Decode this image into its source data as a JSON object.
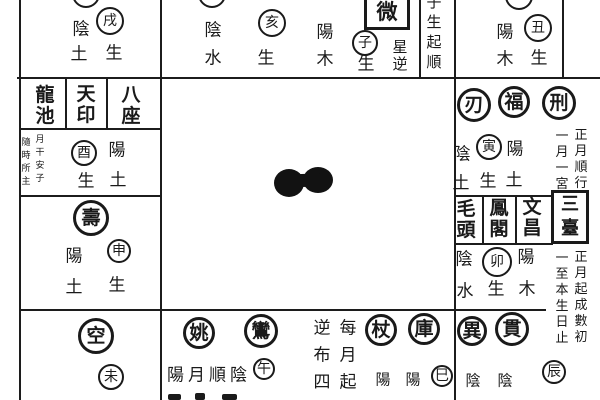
{
  "colors": {
    "ink": "#1a1a1a",
    "paper": "#ffffff"
  },
  "elements": [
    {
      "name": "cutoff-circle-xu-palace",
      "kind": "circle",
      "x": 86,
      "y": -6,
      "r": 14,
      "text": ""
    },
    {
      "name": "branch-circle-xu",
      "kind": "circle",
      "x": 110,
      "y": 21,
      "r": 14,
      "text": "戌"
    },
    {
      "name": "label-yin-xu",
      "kind": "char",
      "x": 81,
      "y": 30,
      "text": "陰"
    },
    {
      "name": "label-earth-xu",
      "kind": "char",
      "x": 79,
      "y": 55,
      "text": "土"
    },
    {
      "name": "label-sheng-xu",
      "kind": "char",
      "x": 114,
      "y": 54,
      "text": "生"
    },
    {
      "name": "cutoff-circle-hai-palace",
      "kind": "circle",
      "x": 212,
      "y": -6,
      "r": 14,
      "text": ""
    },
    {
      "name": "label-yin-hai",
      "kind": "char",
      "x": 213,
      "y": 31,
      "text": "陰"
    },
    {
      "name": "label-water-hai",
      "kind": "char",
      "x": 213,
      "y": 59,
      "text": "水"
    },
    {
      "name": "branch-circle-hai",
      "kind": "circle",
      "x": 272,
      "y": 23,
      "r": 14,
      "text": "亥"
    },
    {
      "name": "label-sheng-hai",
      "kind": "char",
      "x": 266,
      "y": 59,
      "text": "生"
    },
    {
      "name": "star-box-ziwei",
      "kind": "box",
      "x": 387,
      "y": 11,
      "w": 46,
      "h": 38,
      "fs": 21,
      "text": "微"
    },
    {
      "name": "label-yang-zi",
      "kind": "char",
      "x": 325,
      "y": 33,
      "text": "陽"
    },
    {
      "name": "label-wood-zi",
      "kind": "char",
      "x": 325,
      "y": 60,
      "text": "木"
    },
    {
      "name": "branch-circle-zi",
      "kind": "circle",
      "x": 365,
      "y": 43,
      "r": 13,
      "text": "子"
    },
    {
      "name": "label-sheng-zi",
      "kind": "char",
      "x": 366,
      "y": 65,
      "text": "生"
    },
    {
      "name": "note-star-reverse",
      "kind": "vchar",
      "x": 400,
      "y": 56,
      "fs": 15,
      "lh": 17,
      "text": "星\n逆"
    },
    {
      "name": "note-zi-sheng-qi-shun",
      "kind": "vchar",
      "x": 434,
      "y": 32,
      "fs": 15,
      "lh": 20,
      "text": "子\n生\n起\n順"
    },
    {
      "name": "cutoff-circle-chou-palace",
      "kind": "circle",
      "x": 519,
      "y": -4,
      "r": 14,
      "text": ""
    },
    {
      "name": "label-yang-chou",
      "kind": "char",
      "x": 505,
      "y": 33,
      "text": "陽"
    },
    {
      "name": "branch-circle-chou",
      "kind": "circle",
      "x": 538,
      "y": 28,
      "r": 14,
      "text": "丑"
    },
    {
      "name": "label-wood-chou",
      "kind": "char",
      "x": 505,
      "y": 60,
      "text": "木"
    },
    {
      "name": "label-sheng-chou",
      "kind": "char",
      "x": 539,
      "y": 59,
      "text": "生"
    },
    {
      "name": "star-box-longchi",
      "kind": "headerv",
      "x": 45,
      "y": 106,
      "text": "龍\n池"
    },
    {
      "name": "star-box-tianyin",
      "kind": "headerv",
      "x": 86,
      "y": 105,
      "text": "天\n印"
    },
    {
      "name": "star-box-bazuo",
      "kind": "headerv",
      "x": 131,
      "y": 106,
      "text": "八\n座"
    },
    {
      "name": "note-sui-shi-suo-zhu",
      "kind": "vchar tiny",
      "x": 26,
      "y": 163,
      "fs": 9,
      "lh": 13,
      "text": "隨\n時\n所\n主"
    },
    {
      "name": "note-yue-gan-an-zi",
      "kind": "vchar tiny",
      "x": 40,
      "y": 160,
      "fs": 9,
      "lh": 13,
      "text": "月\n干\n安\n子"
    },
    {
      "name": "branch-circle-you",
      "kind": "circle",
      "x": 84,
      "y": 153,
      "r": 13,
      "text": "酉"
    },
    {
      "name": "label-yang-you",
      "kind": "char",
      "x": 117,
      "y": 151,
      "text": "陽"
    },
    {
      "name": "label-sheng-you",
      "kind": "char",
      "x": 86,
      "y": 182,
      "text": "生"
    },
    {
      "name": "label-earth-you",
      "kind": "char",
      "x": 118,
      "y": 181,
      "text": "土"
    },
    {
      "name": "star-circle-shou",
      "kind": "circle star",
      "x": 91,
      "y": 218,
      "r": 18,
      "text": "壽"
    },
    {
      "name": "label-yang-shen",
      "kind": "char",
      "x": 74,
      "y": 257,
      "text": "陽"
    },
    {
      "name": "branch-circle-shen",
      "kind": "circle",
      "x": 119,
      "y": 251,
      "r": 12,
      "text": "申"
    },
    {
      "name": "label-earth-shen",
      "kind": "char",
      "x": 74,
      "y": 288,
      "text": "土"
    },
    {
      "name": "label-sheng-shen",
      "kind": "char",
      "x": 117,
      "y": 286,
      "text": "生"
    },
    {
      "name": "star-circle-kong",
      "kind": "circle star",
      "x": 96,
      "y": 336,
      "r": 18,
      "text": "空"
    },
    {
      "name": "branch-circle-wei",
      "kind": "circle",
      "x": 111,
      "y": 377,
      "r": 13,
      "text": "未"
    },
    {
      "name": "star-circle-yao",
      "kind": "circle star",
      "x": 199,
      "y": 333,
      "r": 16,
      "text": "姚"
    },
    {
      "name": "star-circle-luan",
      "kind": "circle star",
      "x": 261,
      "y": 331,
      "r": 17,
      "text": "鸞"
    },
    {
      "name": "note-yang-yue-shun-yin",
      "kind": "hchar",
      "x": 209,
      "y": 376,
      "fs": 17,
      "ls": 4,
      "text": "陽月順陰"
    },
    {
      "name": "branch-circle-wu",
      "kind": "circle",
      "x": 264,
      "y": 369,
      "r": 11,
      "text": "午"
    },
    {
      "name": "clipped-text-fragment",
      "kind": "fragment",
      "x": 168,
      "y": 394,
      "w": 13,
      "h": 6
    },
    {
      "name": "clipped-text-fragment",
      "kind": "fragment",
      "x": 195,
      "y": 393,
      "w": 10,
      "h": 7
    },
    {
      "name": "clipped-text-fragment",
      "kind": "fragment",
      "x": 222,
      "y": 394,
      "w": 15,
      "h": 6
    },
    {
      "name": "note-ni-bu-si",
      "kind": "vchar",
      "x": 322,
      "y": 356,
      "fs": 17,
      "lh": 27,
      "text": "逆\n布\n四"
    },
    {
      "name": "note-mei-yue-qi",
      "kind": "vchar",
      "x": 348,
      "y": 356,
      "fs": 17,
      "lh": 27,
      "text": "每\n月\n起"
    },
    {
      "name": "star-circle-zhang",
      "kind": "circle star",
      "x": 381,
      "y": 330,
      "r": 16,
      "text": "杖"
    },
    {
      "name": "star-circle-ku",
      "kind": "circle star",
      "x": 424,
      "y": 329,
      "r": 16,
      "text": "庫"
    },
    {
      "name": "label-yang-si-1",
      "kind": "char sm",
      "x": 383,
      "y": 380,
      "text": "陽"
    },
    {
      "name": "label-yang-si-2",
      "kind": "char sm",
      "x": 413,
      "y": 380,
      "text": "陽"
    },
    {
      "name": "branch-circle-si",
      "kind": "circle",
      "x": 442,
      "y": 376,
      "r": 11,
      "text": "巳"
    },
    {
      "name": "star-circle-yi",
      "kind": "circle star",
      "x": 472,
      "y": 331,
      "r": 15,
      "text": "異"
    },
    {
      "name": "star-circle-guan",
      "kind": "circle star",
      "x": 512,
      "y": 329,
      "r": 17,
      "text": "貫"
    },
    {
      "name": "label-yin-chen-1",
      "kind": "char sm",
      "x": 473,
      "y": 381,
      "text": "陰"
    },
    {
      "name": "label-yin-chen-2",
      "kind": "char sm",
      "x": 505,
      "y": 381,
      "text": "陰"
    },
    {
      "name": "branch-circle-chen",
      "kind": "circle",
      "x": 554,
      "y": 372,
      "r": 12,
      "text": "辰"
    },
    {
      "name": "star-circle-ren",
      "kind": "circle star",
      "x": 474,
      "y": 105,
      "r": 17,
      "text": "刃"
    },
    {
      "name": "star-circle-fu",
      "kind": "circle star",
      "x": 514,
      "y": 102,
      "r": 16,
      "text": "福"
    },
    {
      "name": "star-circle-xing",
      "kind": "circle star",
      "x": 559,
      "y": 103,
      "r": 17,
      "text": "刑"
    },
    {
      "name": "label-yin-yinpalace",
      "kind": "char",
      "x": 462,
      "y": 155,
      "text": "陰"
    },
    {
      "name": "branch-circle-yin",
      "kind": "circle",
      "x": 489,
      "y": 147,
      "r": 13,
      "text": "寅"
    },
    {
      "name": "label-yang-yinpalace",
      "kind": "char",
      "x": 515,
      "y": 150,
      "text": "陽"
    },
    {
      "name": "label-earth-yinpalace-1",
      "kind": "char",
      "x": 461,
      "y": 184,
      "text": "土"
    },
    {
      "name": "label-sheng-yinpalace",
      "kind": "char",
      "x": 488,
      "y": 182,
      "text": "生"
    },
    {
      "name": "label-earth-yinpalace-2",
      "kind": "char",
      "x": 514,
      "y": 181,
      "text": "土"
    },
    {
      "name": "note-zheng-yue-shun-xing",
      "kind": "vchar instr",
      "x": 581,
      "y": 160,
      "fs": 13,
      "lh": 16,
      "text": "正\n月\n順\n行"
    },
    {
      "name": "note-yi-yue-yi-gong",
      "kind": "vchar instr",
      "x": 562,
      "y": 161,
      "fs": 13,
      "lh": 16,
      "text": "一\n月\n一\n宮"
    },
    {
      "name": "star-box-maotou",
      "kind": "headerv",
      "x": 466,
      "y": 220,
      "text": "毛\n頭"
    },
    {
      "name": "star-box-fengge",
      "kind": "headerv",
      "x": 499,
      "y": 219,
      "text": "鳳\n閣"
    },
    {
      "name": "star-box-wenchang",
      "kind": "headerv",
      "x": 532,
      "y": 218,
      "text": "文\n昌"
    },
    {
      "name": "star-box-santai",
      "kind": "box vbox",
      "x": 570,
      "y": 217,
      "w": 38,
      "h": 54,
      "fs": 18,
      "text": "三\n臺"
    },
    {
      "name": "label-yin-mao",
      "kind": "char",
      "x": 464,
      "y": 260,
      "text": "陰"
    },
    {
      "name": "branch-circle-mao",
      "kind": "circle",
      "x": 497,
      "y": 262,
      "r": 15,
      "text": "卯"
    },
    {
      "name": "label-yang-mao",
      "kind": "char",
      "x": 526,
      "y": 258,
      "text": "陽"
    },
    {
      "name": "label-water-mao",
      "kind": "char",
      "x": 465,
      "y": 292,
      "text": "水"
    },
    {
      "name": "label-sheng-mao",
      "kind": "char",
      "x": 496,
      "y": 290,
      "text": "生"
    },
    {
      "name": "label-wood-mao",
      "kind": "char",
      "x": 527,
      "y": 290,
      "text": "木"
    },
    {
      "name": "note-zheng-yue-qi-cheng-shu-chu",
      "kind": "vchar instr",
      "x": 581,
      "y": 298,
      "fs": 13,
      "lh": 16,
      "text": "正\n月\n起\n成\n數\n初"
    },
    {
      "name": "note-yi-zhi-ben-sheng-ri-zhi",
      "kind": "vchar instr",
      "x": 562,
      "y": 299,
      "fs": 13,
      "lh": 16,
      "text": "一\n至\n本\n生\n日\n止"
    }
  ]
}
